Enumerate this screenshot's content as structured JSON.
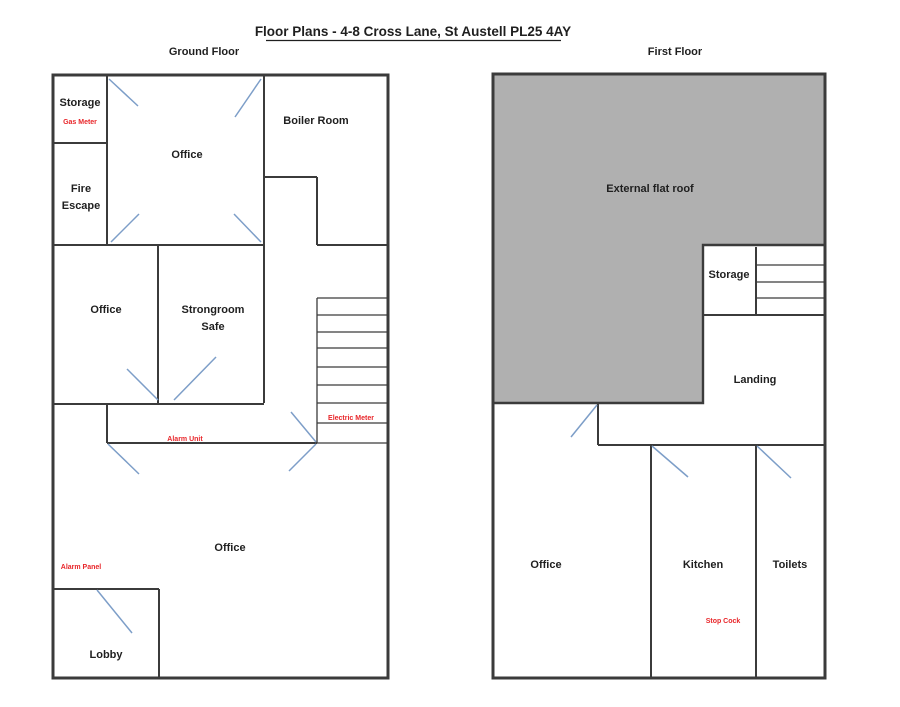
{
  "title": "Floor Plans - 4-8 Cross Lane, St Austell PL25 4AY",
  "colors": {
    "wall": "#3b3b3b",
    "roof": "#b0b0b0",
    "door": "#7d9ec8",
    "red": "#e8262a",
    "text": "#1f1f1f"
  },
  "ground_floor": {
    "label": "Ground Floor",
    "labels": {
      "storage": "Storage",
      "gas_meter": "Gas Meter",
      "fire_escape": [
        "Fire",
        "Escape"
      ],
      "office_top": "Office",
      "boiler_room": "Boiler Room",
      "office_middle": "Office",
      "strongroom": [
        "Strongroom",
        "Safe"
      ],
      "electric_meter": "Electric Meter",
      "alarm_unit": "Alarm Unit",
      "office_main": "Office",
      "alarm_panel": "Alarm Panel",
      "lobby": "Lobby"
    }
  },
  "first_floor": {
    "label": "First Floor",
    "labels": {
      "external_flat_roof": "External flat roof",
      "storage": "Storage",
      "landing": "Landing",
      "office": "Office",
      "kitchen": "Kitchen",
      "toilets": "Toilets",
      "stop_cock": "Stop Cock"
    }
  }
}
